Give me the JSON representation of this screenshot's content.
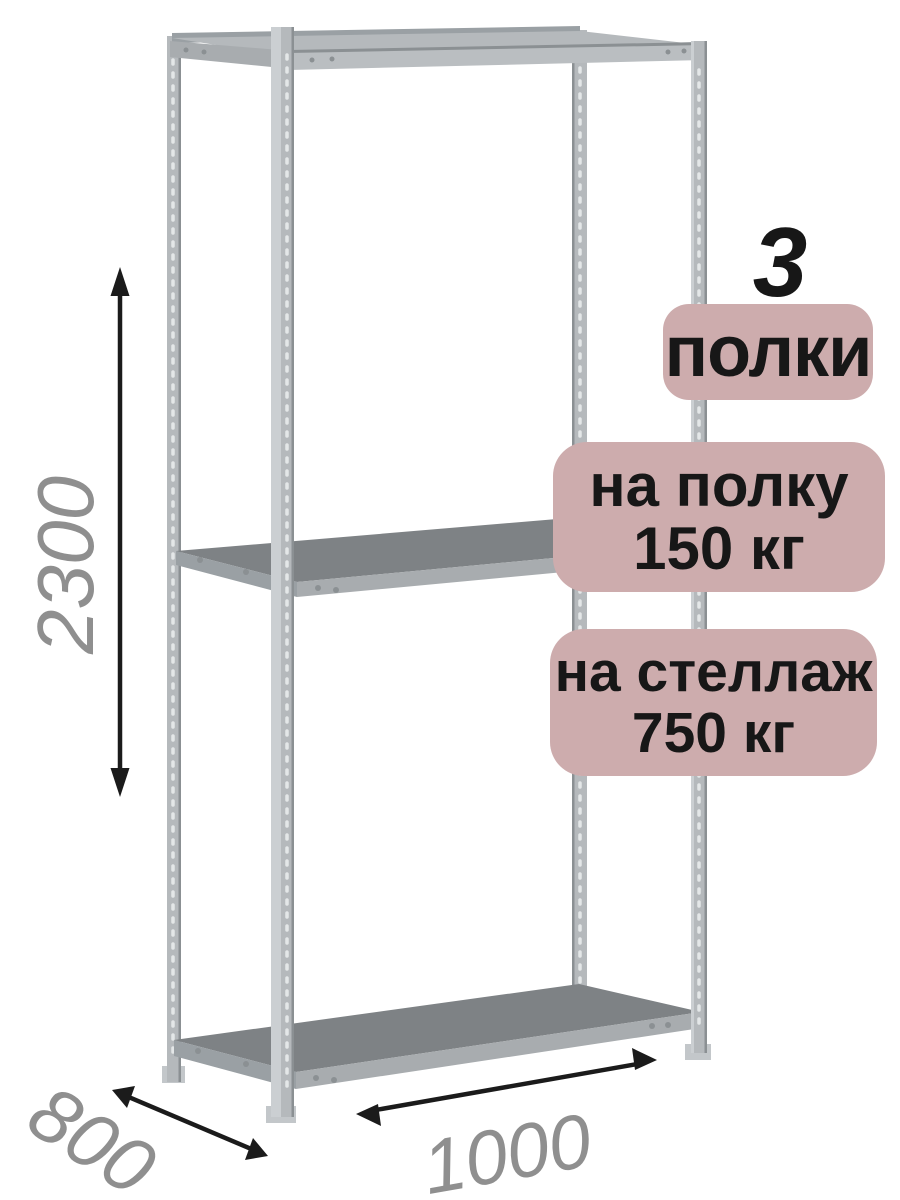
{
  "badges": {
    "count_number": "3",
    "count_label": "полки",
    "per_shelf_line1": "на полку",
    "per_shelf_line2": "150 кг",
    "per_rack_line1": "на стеллаж",
    "per_rack_line2": "750 кг"
  },
  "dimensions": {
    "height": "2300",
    "depth": "800",
    "width": "1000"
  },
  "colors": {
    "background": "#ffffff",
    "badge_bg": "#cdacad",
    "badge_text": "#171717",
    "dim_text": "#8f8f8f",
    "arrow": "#1b1b1b",
    "metal_mid": "#b5b9bc",
    "metal_light": "#cbcfd2",
    "metal_beam": "#babec1",
    "metal_band": "#a8acaf",
    "metal_side": "#9aa0a4",
    "metal_edge": "#8b9093",
    "metal_foot": "#c3c7ca",
    "shelf_top": "#7e8285",
    "perf": "#e4e7e8"
  }
}
